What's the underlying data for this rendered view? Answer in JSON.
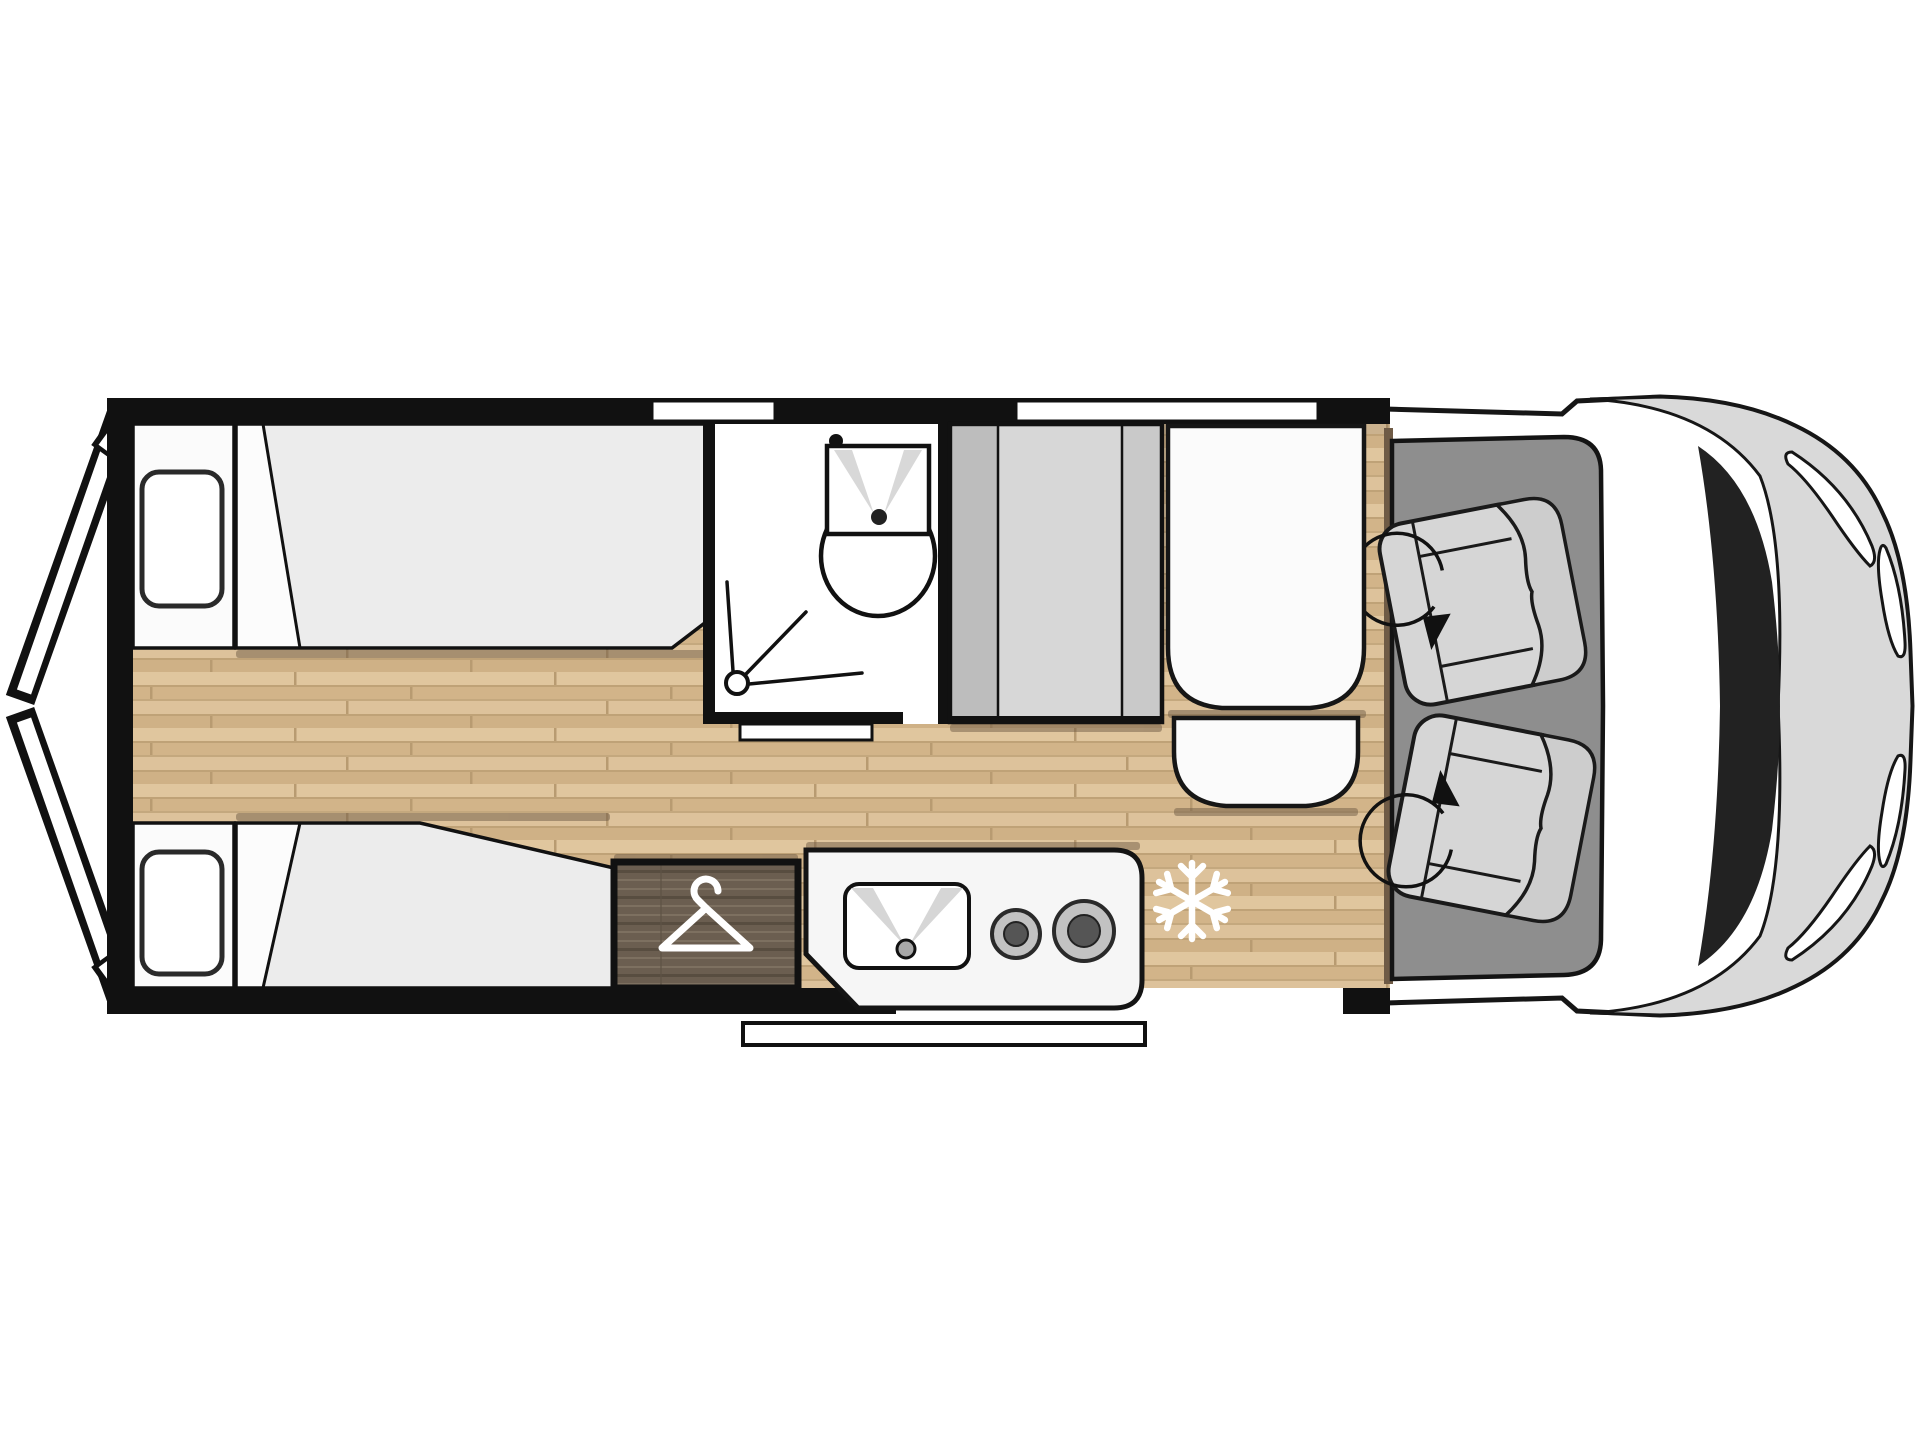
{
  "page": {
    "description": "Top-down floor plan drawing of a camper van, front of vehicle facing right, no text labels visible",
    "background": "#ffffff"
  },
  "colors": {
    "wall_black": "#111111",
    "floor_wood_light": "#e0c69e",
    "floor_wood_base": "#d7ba90",
    "floor_wood_dark": "#cbae84",
    "mattress_gray": "#ececec",
    "linen_white": "#fbfbfb",
    "cabinet_gray": "#c9c9c9",
    "cabinet_panel_light": "#d7d7d7",
    "wardrobe_wood_dark": "#6b5e50",
    "kitchen_white": "#f6f6f6",
    "burner_ring": "#c2c2c2",
    "burner_center": "#555555",
    "cab_floor_gray": "#8e8e8e",
    "seat_gray": "#d6d6d6",
    "seat_back_gray": "#cdcdcd",
    "van_body_gray": "#d9d9d9",
    "pillar_dark": "#222222",
    "shadow_brown": "#6f5b46",
    "icon_white": "#ffffff"
  },
  "rooms": {
    "rear_bedroom": {
      "label": "rear bedroom with two single beds and open rear doors"
    },
    "bathroom": {
      "label": "bathroom with washbasin and shower"
    },
    "wardrobe": {
      "label": "wardrobe with clothes hanger symbol"
    },
    "kitchen": {
      "label": "kitchen block with sink and two burner hob"
    },
    "fridge": {
      "label": "refrigerator position marked by snowflake"
    },
    "lounge": {
      "label": "sideboard and bench seat behind cab"
    },
    "cab": {
      "label": "driver cab with two swivel seats"
    }
  },
  "fixtures": {
    "beds": 2,
    "pillows": 2,
    "cab_seats": 2,
    "burners": 2,
    "windows": 2,
    "entry_step": {
      "label": "sliding door entry step"
    },
    "rear_doors": {
      "label": "rear barn doors shown open"
    }
  },
  "icons": {
    "hanger": "clothes-hanger-icon",
    "snowflake": "snowflake-icon",
    "swivel_arrow": "swivel-arrow-icon",
    "shower": "shower-head-icon",
    "washbasin": "washbasin-icon",
    "hob": "hob-burners-icon"
  }
}
